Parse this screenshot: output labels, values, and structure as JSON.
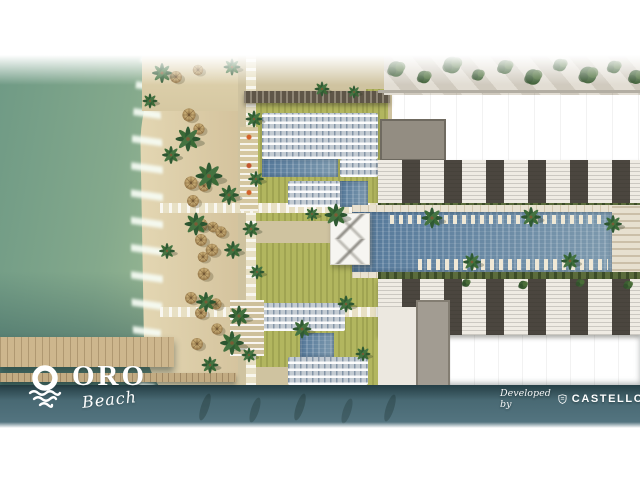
{
  "page": {
    "background": "#ffffff",
    "description": "Aerial masterplan rendering of a beachfront resort"
  },
  "branding": {
    "logo": {
      "icon": "sun-over-waves-icon",
      "title": "ORO",
      "tagline": "Beach",
      "text_color": "#ffffff"
    },
    "developer_credit": {
      "prefix": "Developed by",
      "icon": "castello-crest-icon",
      "name": "CASTELLO",
      "text_color": "#ffffff"
    }
  },
  "scene": {
    "palette": {
      "sea": "#7fa78c",
      "sea_deep": "#3f6068",
      "sand": "#d9c9a4",
      "deck": "#cfc3a0",
      "path": "#e8e0c4",
      "lawn": "#b2b65f",
      "pool": "#54789a",
      "pool_light": "#7e9aae",
      "building": "#f2efe9",
      "building_recess": "#3e3a34",
      "hedge": "#5b6c3c",
      "pier": "#cdb68d",
      "umbrella": "#c2a06b",
      "palm": "#2f5a33",
      "canopy": "#f6f5f1",
      "foam": "#eef7ec"
    }
  }
}
